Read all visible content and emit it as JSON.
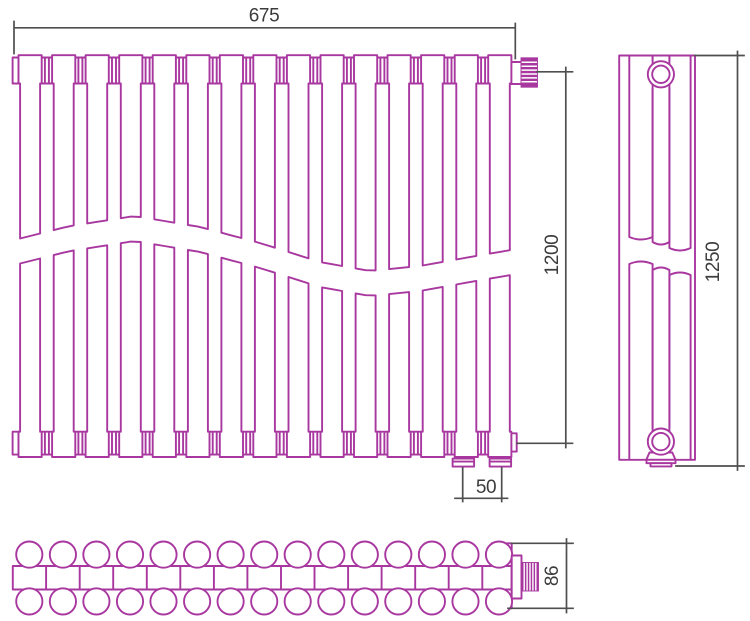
{
  "drawing": {
    "stroke_color": "#a8379f",
    "dim_line_color": "#4f4f4f",
    "text_color": "#3c3c3c",
    "background": "#ffffff"
  },
  "dimensions": {
    "width": "675",
    "height": "1200",
    "overall_height": "1250",
    "connection_spacing": "50",
    "depth": "86"
  },
  "front_view": {
    "slat_count": 15
  },
  "side_view": {
    "column_count": 3
  },
  "bottom_view": {
    "tube_pair_count": 15
  }
}
